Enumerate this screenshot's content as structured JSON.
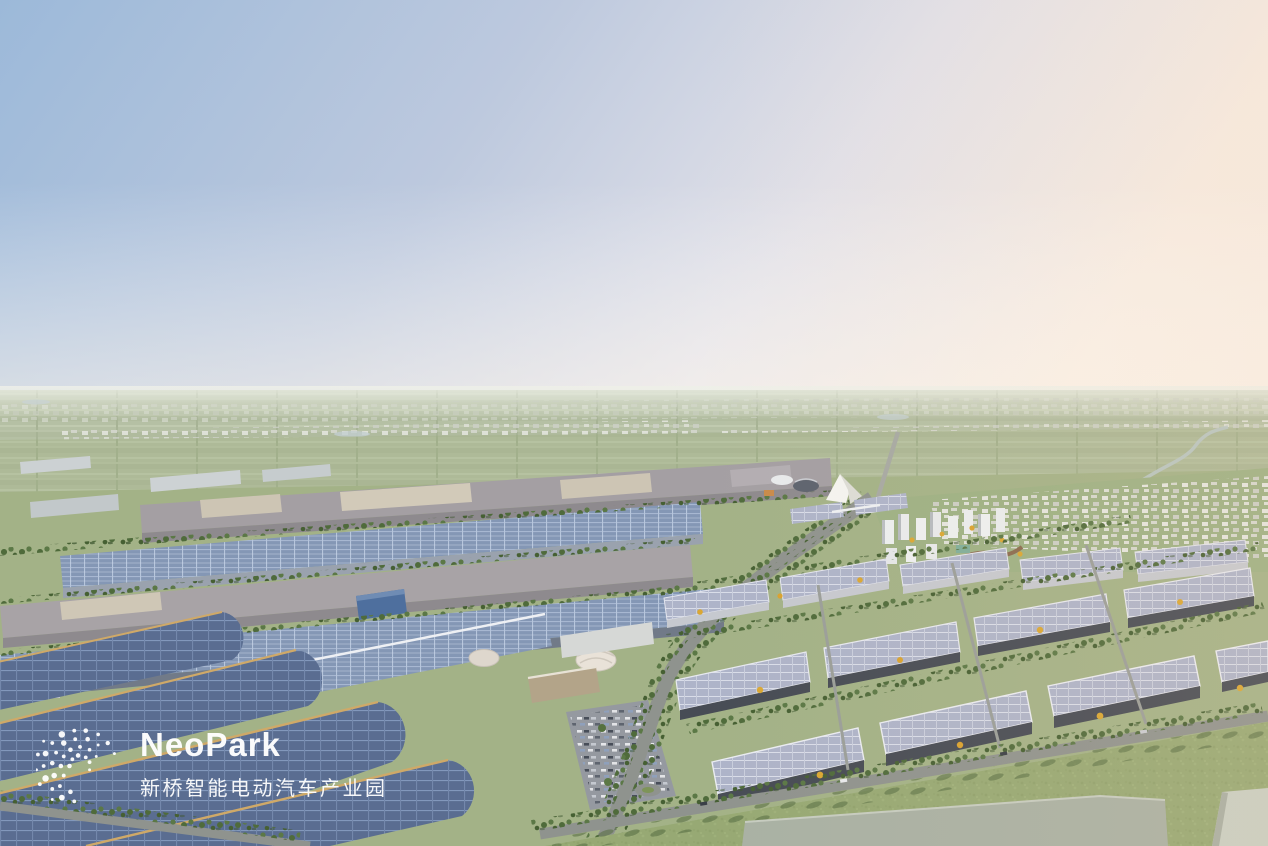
{
  "scene": {
    "name": "NeoPark aerial rendering",
    "description": "Dusk aerial rendering of a smart electric-vehicle industrial park: factory halls and warehouses with rooftop solar panels, tree-lined roads, a white tent landmark, residential towers and farm fields stretching to a hazy horizon"
  },
  "watermark": {
    "brand": "NeoPark",
    "subtitle": "新桥智能电动汽车产业园",
    "logo_icon": "dot-swirl-logo",
    "text_color": "#ffffff"
  },
  "palette": {
    "sky_left": "#9cb9d9",
    "sky_right": "#f7ece2",
    "horizon_haze": "#e3e6d9",
    "far_field": "#b5c0a4",
    "mid_field": "#a3b287",
    "grass": "#96a972",
    "tree_green": "#4f6b3b",
    "tree_autumn": "#daa733",
    "road": "#8f938e",
    "solar_blue": "#8497b5",
    "solar_deep": "#5a6d91",
    "solar_pale": "#aeb4c9",
    "roof_mauve": "#a49fa3",
    "roof_beige": "#cdc5b4",
    "gold_trim": "#cfa968",
    "wall_dark": "#474c55",
    "town_white": "#e8e9e4",
    "slab_gray": "#a9b1a4"
  }
}
